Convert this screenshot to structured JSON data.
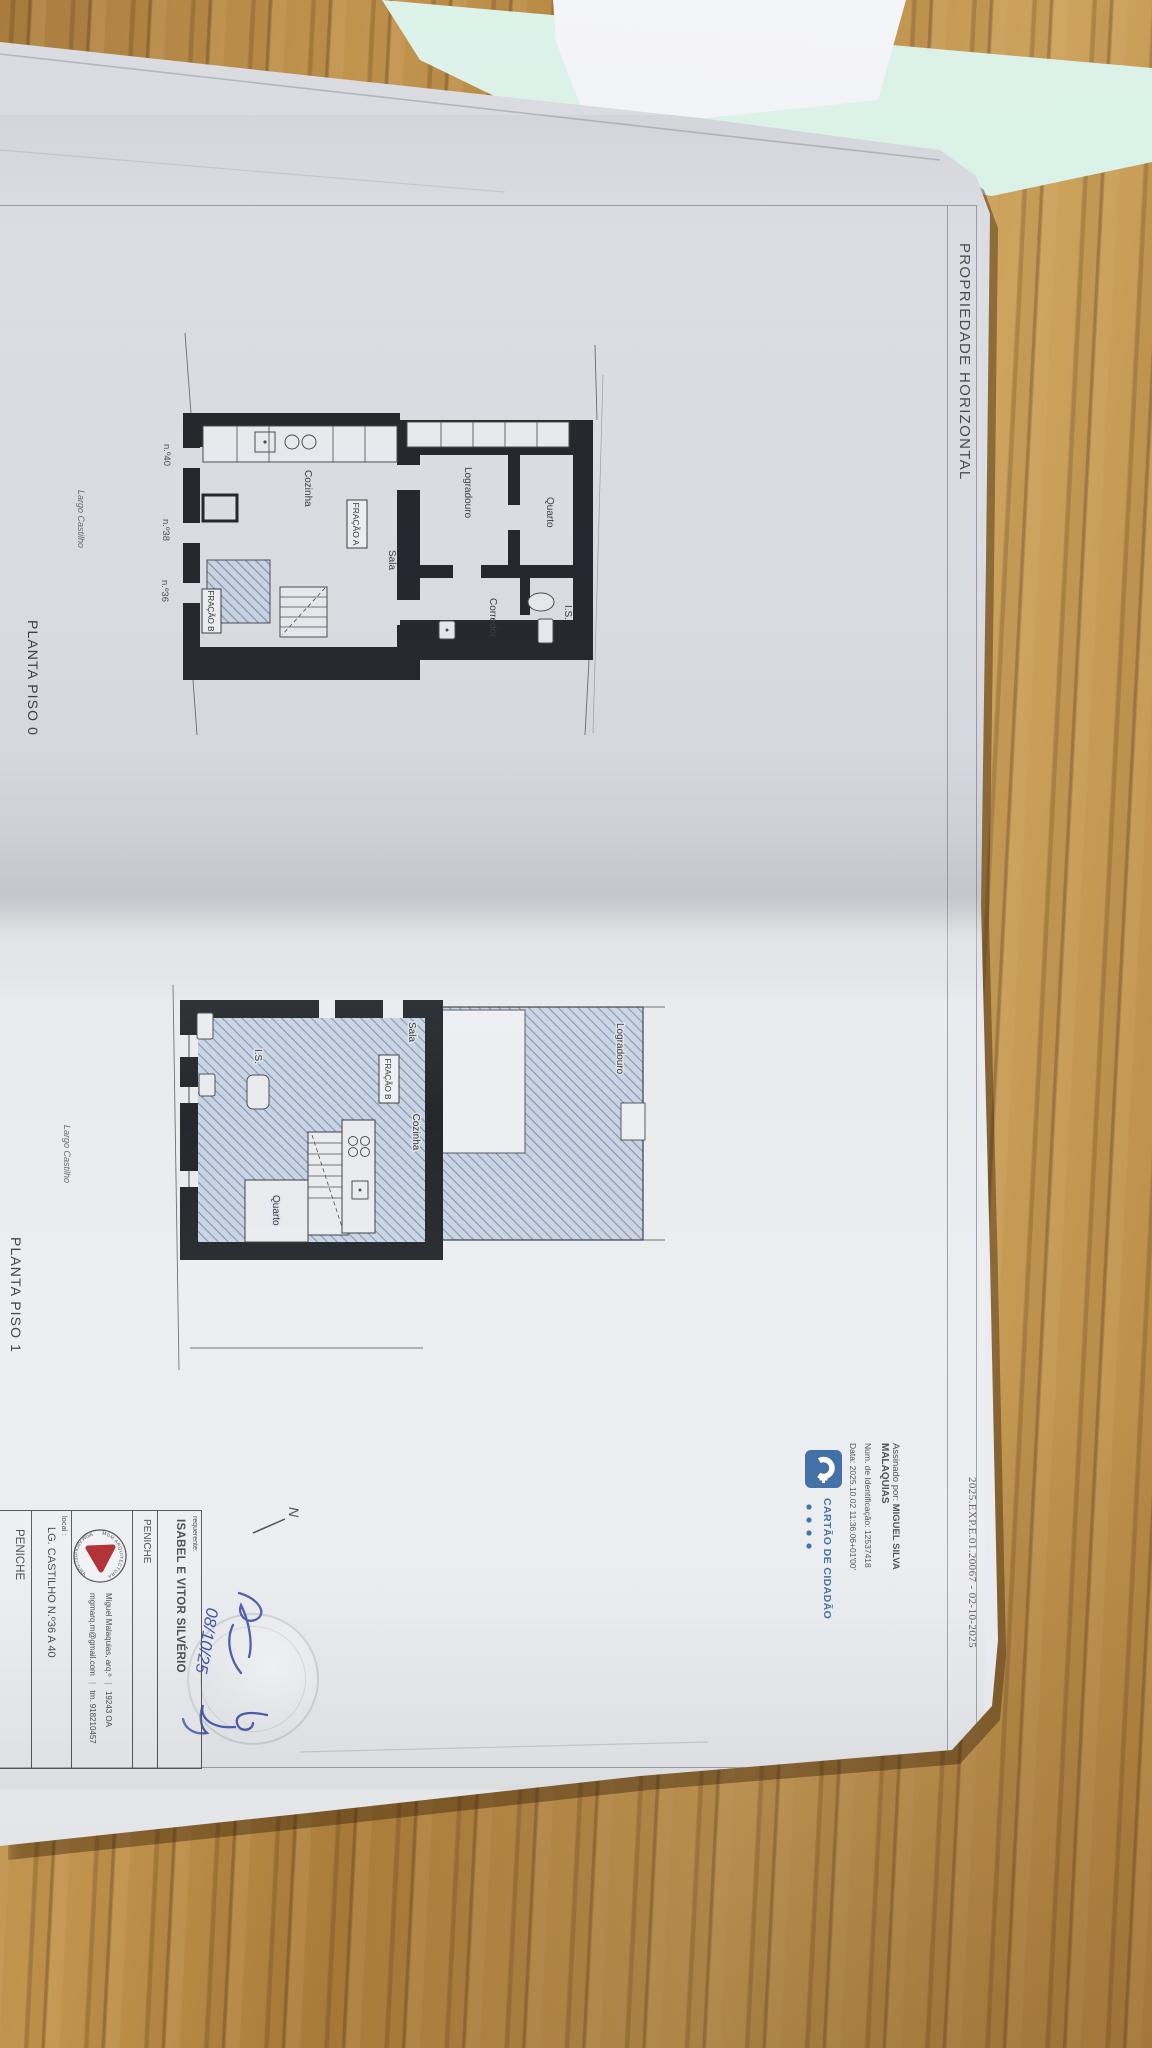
{
  "header": {
    "title": "PROPRIEDADE HORIZONTAL",
    "reference": "2025.EXP.E.01.20067 - 02-10-2025"
  },
  "plan0": {
    "caption": "PLANTA PISO 0",
    "street": "Largo Castilho",
    "rooms": {
      "quarto": "Quarto",
      "is": "I.S.",
      "corredor": "Corredor",
      "logradouro": "Logradouro",
      "sala": "Sala",
      "cozinha": "Cozinha"
    },
    "fracao_a": "FRAÇÃO A",
    "fracao_b": "FRAÇÃO B",
    "door_numbers": [
      "n.º40",
      "n.º38",
      "n.º36"
    ]
  },
  "plan1": {
    "caption": "PLANTA PISO 1",
    "street": "Largo Castilho",
    "rooms": {
      "sala": "Sala",
      "cozinha": "Cozinha",
      "quarto": "Quarto",
      "is": "I.S.",
      "logradouro": "Logradouro"
    },
    "fracao_b": "FRAÇÃO B"
  },
  "signature_stamp": {
    "label": "Assinado por:",
    "name_line1": "MIGUEL SILVA",
    "name_line2": "MALAQUIAS",
    "id_line": "Num. de Identificação: 12537418",
    "date_line": "Data: 2025.10.02 11:36:06+01'00'"
  },
  "cartao_cidadao": {
    "label": "CARTÃO DE CIDADÃO"
  },
  "north_label": "N",
  "handwritten": {
    "date": "08/10/25"
  },
  "title_block": {
    "requerente_label": "requerente:",
    "requerente_name": "ISABEL E VITOR SILVÉRIO",
    "requerente_city": "PENICHE",
    "architect": "Miguel Malaquias, arq.º",
    "architect_reg": "19243 OA",
    "email": "mgmarq.m@gmail.com",
    "phone": "tm. 918210457",
    "local_label": "local :",
    "local_value": "LG. CASTILHO N.º36 A 40",
    "local_city": "PENICHE",
    "logo_text_top": "MGM ARQUITECTURA",
    "logo_text_bottom": "MGM ARQUITECTURA"
  },
  "colors": {
    "cc_blue": "#33659f",
    "mgm_red": "#a91d22",
    "hand_ink": "#3646a3",
    "hatch_line": "#8095b5",
    "hatch_bg": "#ccd5e3",
    "wall": "#24272c",
    "mint_sheet": "#d5efe6"
  }
}
